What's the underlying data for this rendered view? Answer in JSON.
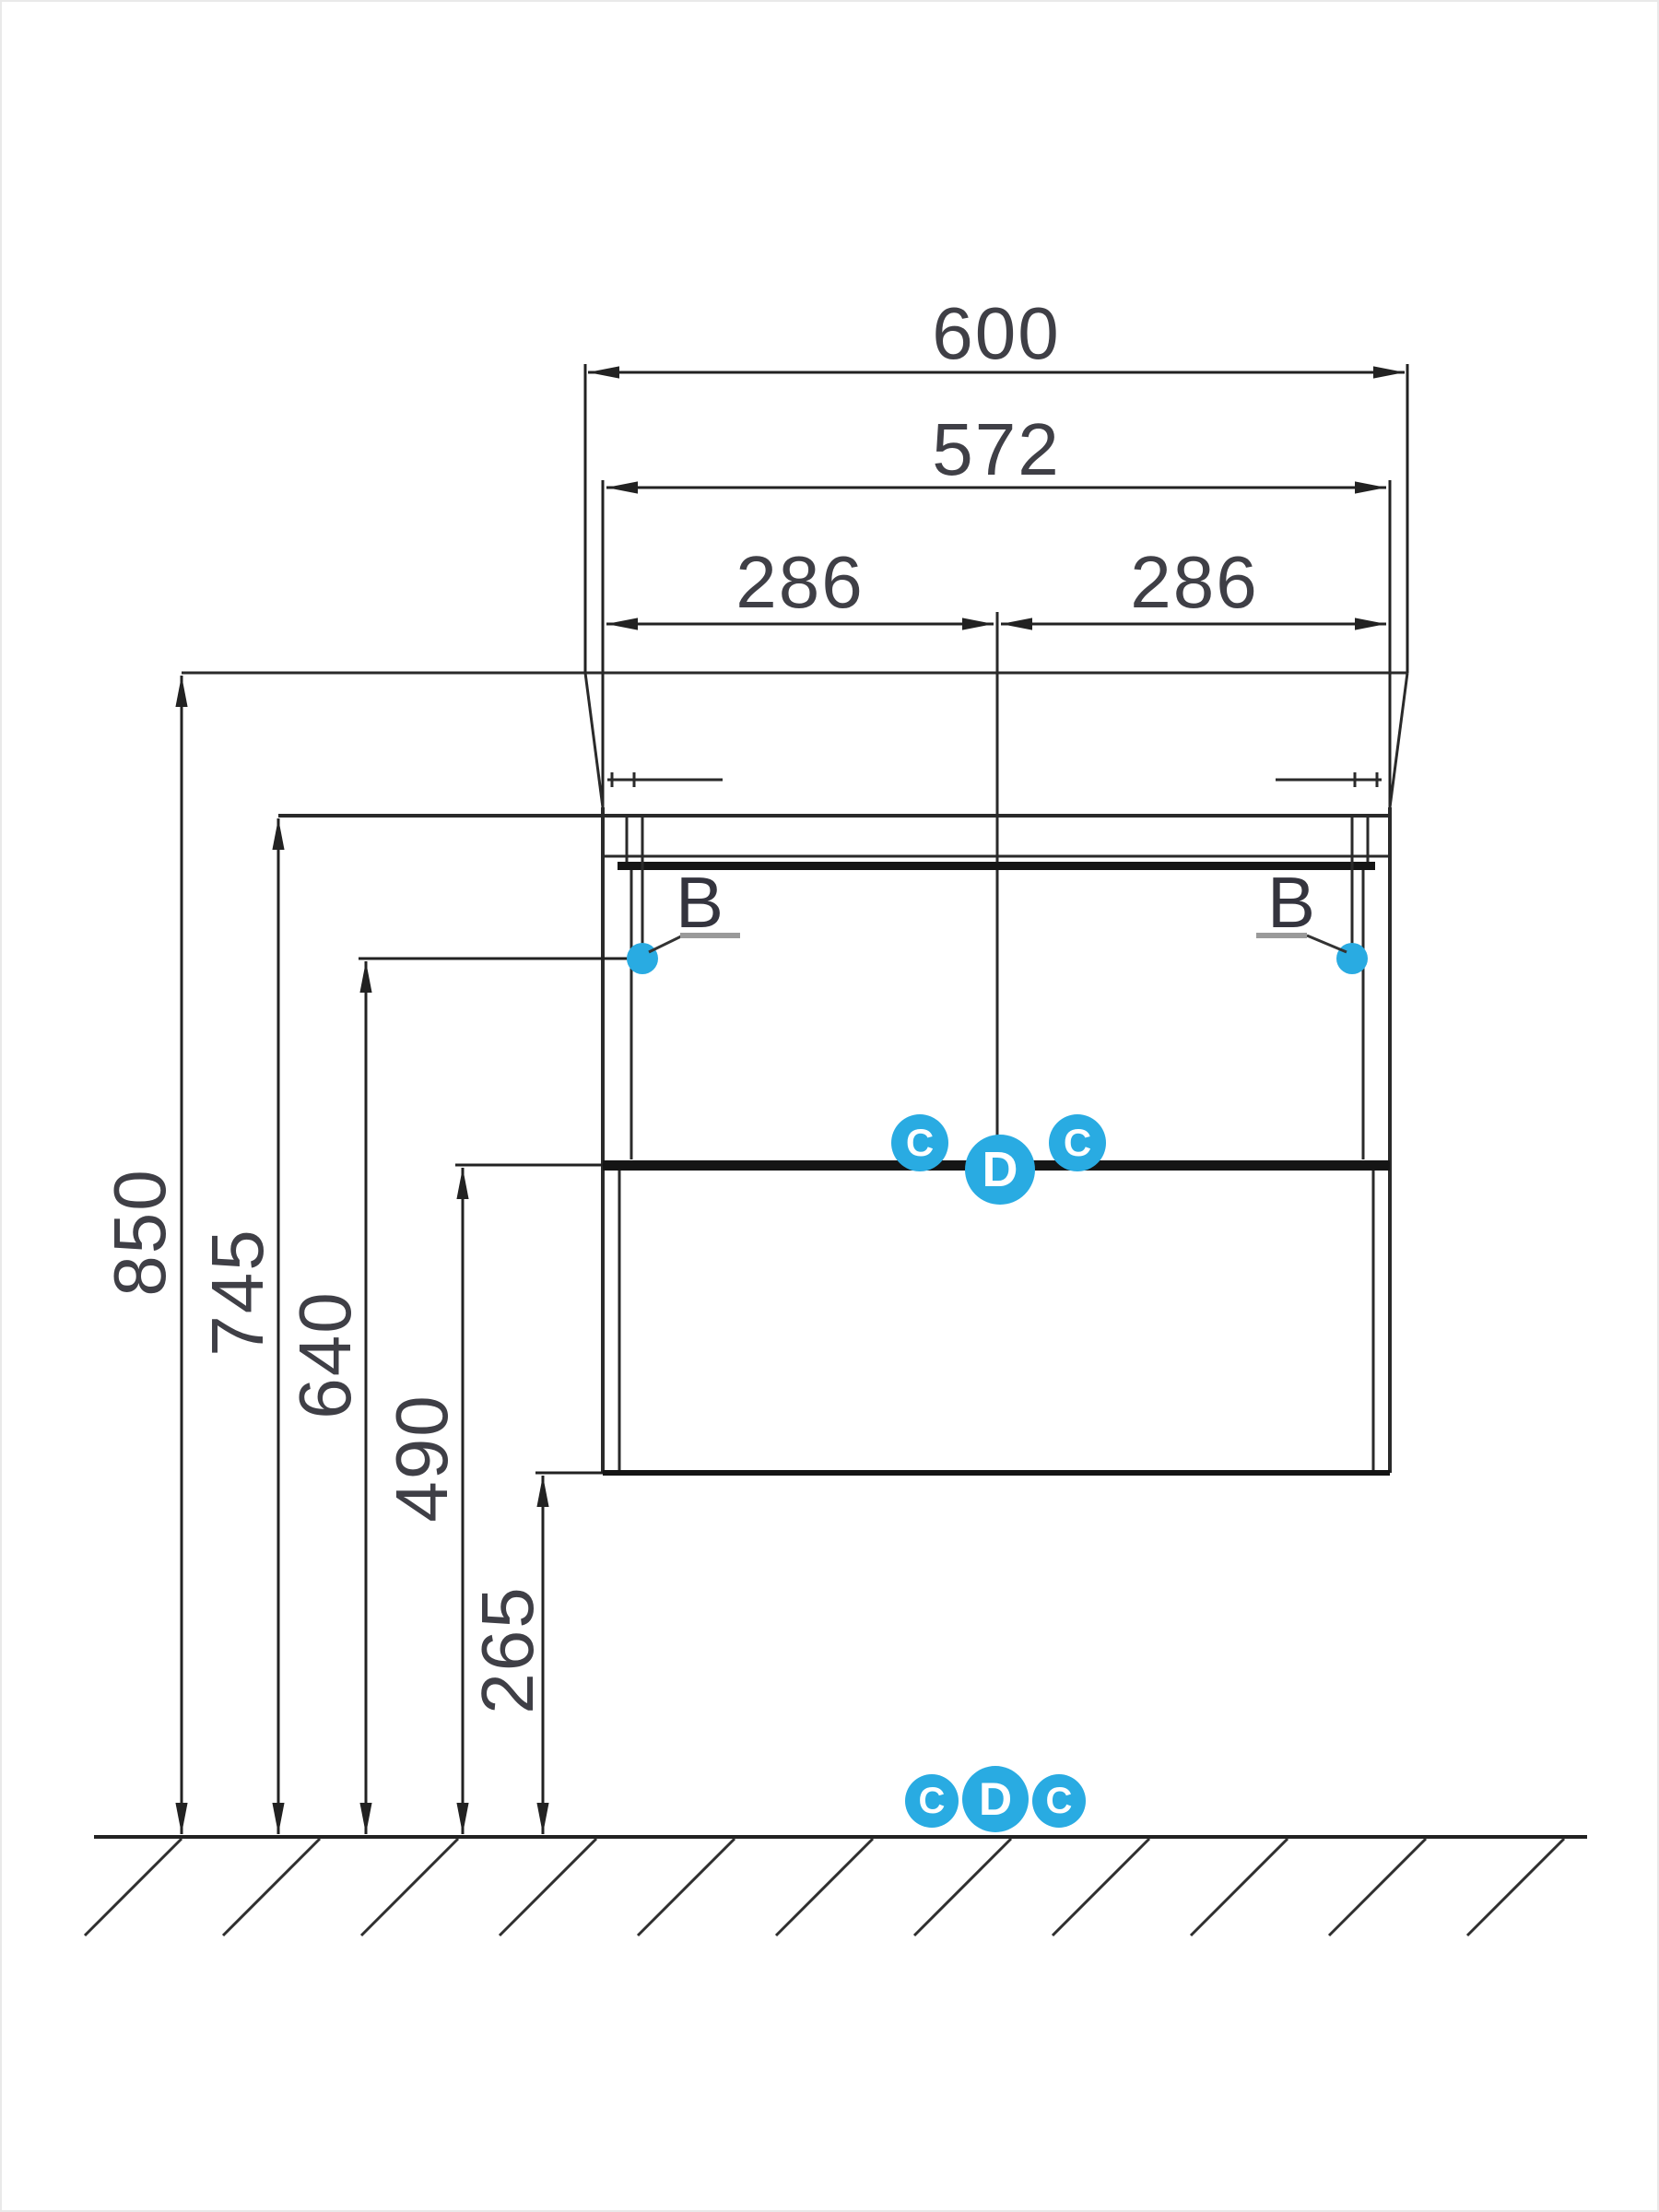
{
  "dimensions": {
    "horizontal": {
      "overall_width": "600",
      "inner_width": "572",
      "center_left": "286",
      "center_right": "286"
    },
    "vertical": {
      "basin_top_height": "850",
      "countertop_height": "745",
      "bracket_height": "640",
      "divider_height": "490",
      "cabinet_bottom_height": "265"
    }
  },
  "callouts": {
    "bracket_left": "B",
    "bracket_right": "B",
    "divider_markers": [
      "C",
      "D",
      "C"
    ],
    "floor_markers": [
      "C",
      "D",
      "C"
    ]
  },
  "colors": {
    "line": "#2a2a2a",
    "thick_line": "#151515",
    "dim_text": "#3f3f46",
    "marker_fill": "#29abe2",
    "marker_text": "#ffffff",
    "leader_underline": "#9a9a9a"
  }
}
